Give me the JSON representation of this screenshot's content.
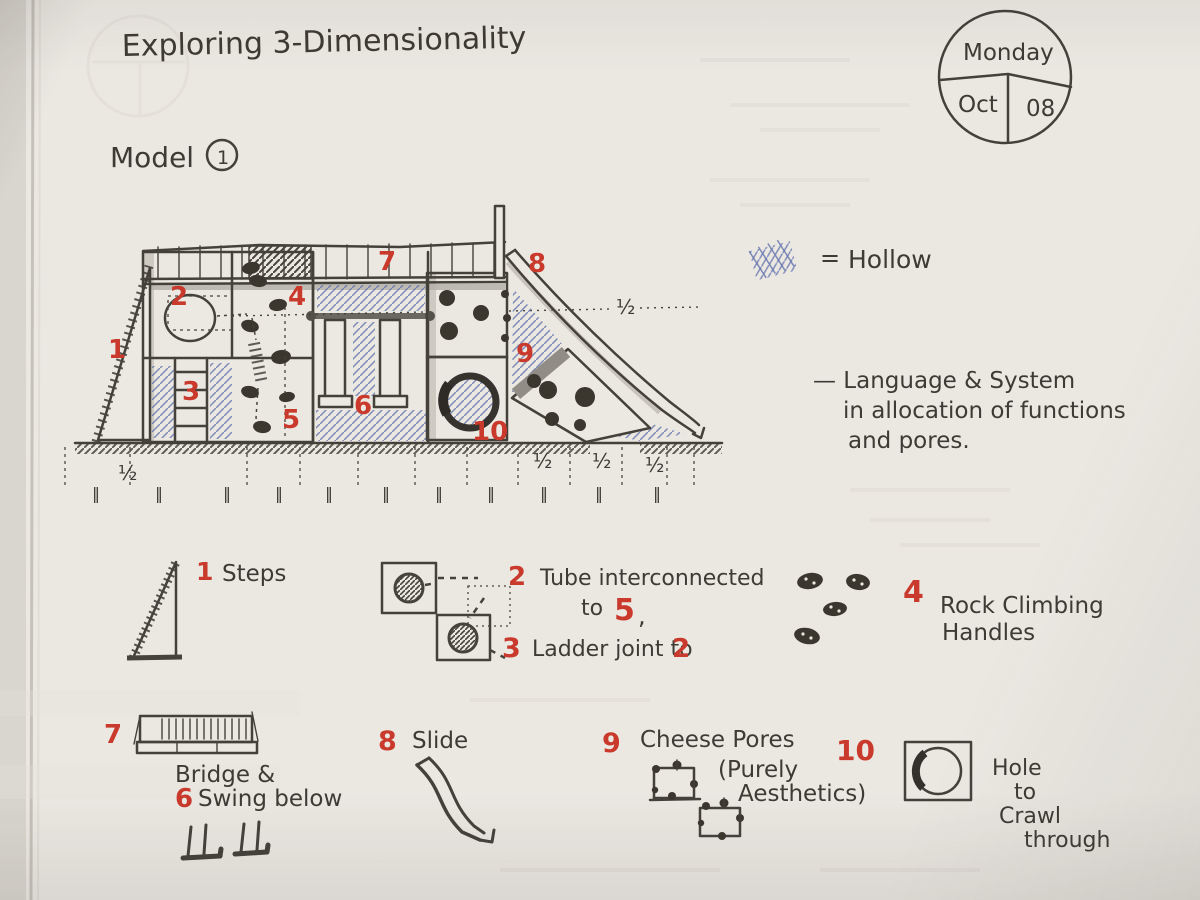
{
  "header": {
    "title": "Exploring 3-Dimensionality",
    "model_label": "Model",
    "model_number": "1"
  },
  "date_badge": {
    "day": "Monday",
    "month": "Oct",
    "date": "08"
  },
  "hollow_key": {
    "equals": "=",
    "label": "Hollow"
  },
  "note": {
    "line1": "— Language & System",
    "line2": "in allocation of functions",
    "line3": "and pores."
  },
  "markers": {
    "n1": "1",
    "n2": "2",
    "n3": "3",
    "n4": "4",
    "n5": "5",
    "n6": "6",
    "n7": "7",
    "n8": "8",
    "n9": "9",
    "n10": "10"
  },
  "dims": {
    "half": "½",
    "tick": "‖"
  },
  "legend": {
    "steps": {
      "num": "1",
      "label": "Steps"
    },
    "tube": {
      "num": "2",
      "line1": "Tube interconnected",
      "to": "to",
      "target": "5",
      "comma": ",",
      "ladder_num": "3",
      "line2": "Ladder joint to",
      "ladder_target": "2"
    },
    "handles": {
      "num": "4",
      "line1": "Rock Climbing",
      "line2": "Handles"
    },
    "bridge": {
      "num": "7",
      "line1": "Bridge &",
      "swing_num": "6",
      "line2": "Swing below"
    },
    "slide": {
      "num": "8",
      "label": "Slide"
    },
    "pores": {
      "num": "9",
      "line1": "Cheese Pores",
      "line2": "(Purely",
      "line3": "Aesthetics)"
    },
    "hole": {
      "num": "10",
      "line1": "Hole",
      "line2": "to",
      "line3": "Crawl",
      "line4": "through"
    }
  },
  "colors": {
    "ink": "#3e3a34",
    "red": "#c9392c",
    "blue": "#6272ad",
    "paper": "#ebe8e2"
  }
}
